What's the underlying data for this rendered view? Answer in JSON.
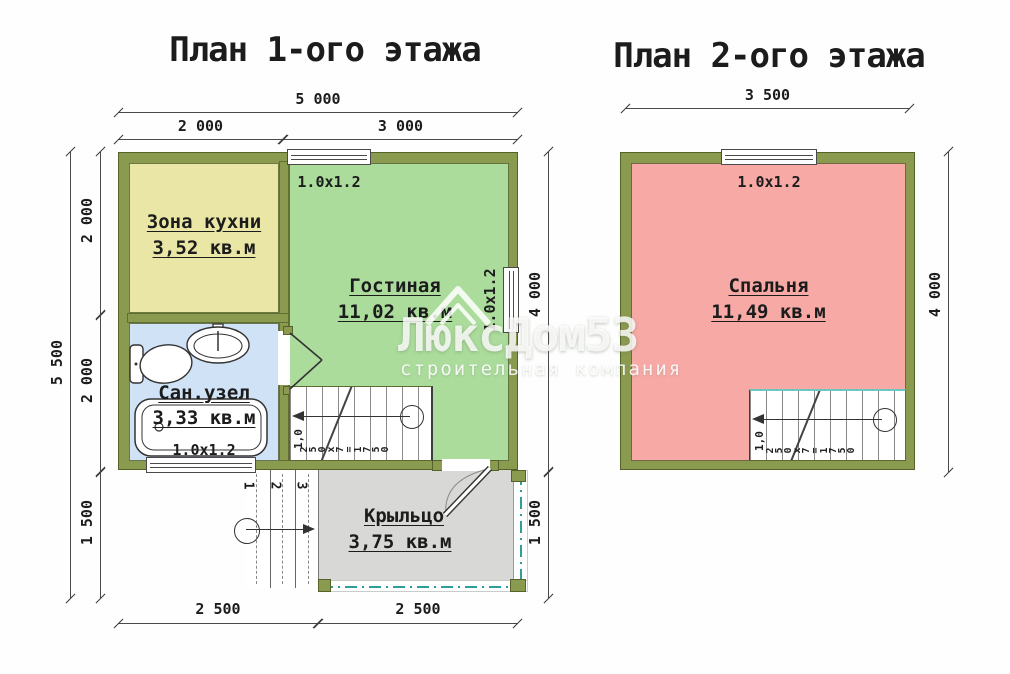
{
  "titles": {
    "plan1": "План 1-ого этажа",
    "plan2": "План 2-ого этажа"
  },
  "plan1": {
    "dims": {
      "top_total": "5 000",
      "top_left": "2 000",
      "top_right": "3 000",
      "left_total": "5 500",
      "left_segments": [
        "2 000",
        "2 000",
        "1 500"
      ],
      "right_upper": "4 000",
      "right_lower": "1 500",
      "bottom_left": "2 500",
      "bottom_right": "2 500"
    },
    "rooms": {
      "kitchen": {
        "name": "Зона кухни",
        "area": "3,52 кв.м"
      },
      "living": {
        "name": "Гостиная",
        "area": "11,02 кв.м"
      },
      "bath": {
        "name": "Сан.узел",
        "area": "3,33 кв.м"
      },
      "porch": {
        "name": "Крыльцо",
        "area": "3,75 кв.м"
      }
    },
    "windows": {
      "top": "1.0x1.2",
      "right": "1.0x1.2",
      "bath": "1.0x1.2"
    },
    "stairs": {
      "width_label": "1,0",
      "run_label": "250x7=1750"
    },
    "steps": [
      "1",
      "2",
      "3"
    ]
  },
  "plan2": {
    "dims": {
      "top_total": "3 500",
      "right_total": "4 000"
    },
    "rooms": {
      "bedroom": {
        "name": "Спальня",
        "area": "11,49 кв.м"
      }
    },
    "windows": {
      "top": "1.0x1.2"
    },
    "stairs": {
      "width_label": "1,0",
      "run_label": "250x7=1750"
    }
  },
  "watermark": {
    "brand": "ЛюксДом53",
    "tagline": "строительная компания"
  },
  "colors": {
    "wall": "#8a9a4e",
    "kitchen": "#eae7a6",
    "living": "#abdc9c",
    "bath": "#cfe2f6",
    "bedroom": "#f7a9a6",
    "porch": "#d8d8d6",
    "porch_edge_teal": "#2f9e98",
    "line": "#4a4a4a"
  }
}
